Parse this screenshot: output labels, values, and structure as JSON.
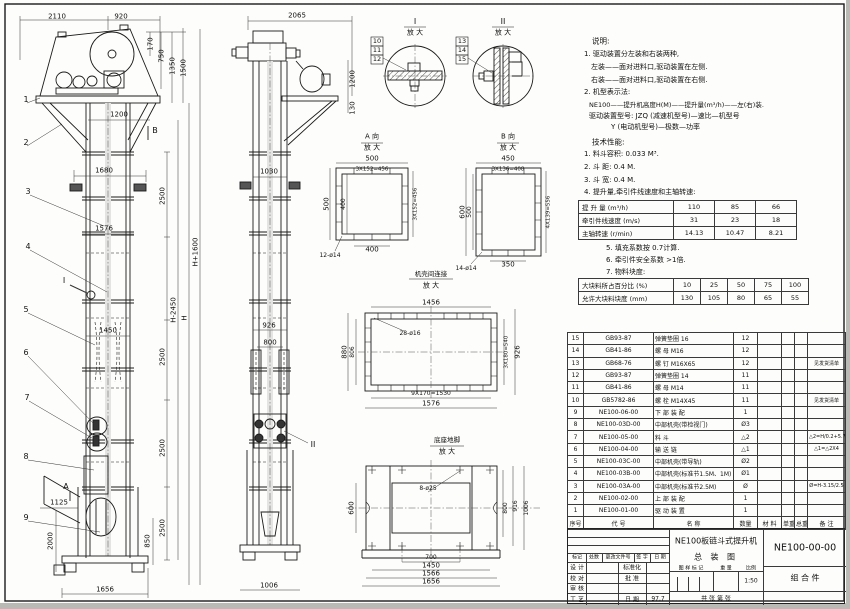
{
  "notes": {
    "heading": "说明:",
    "lines": [
      "1. 驱动装置分左装和右装两种,",
      "左装——面对进料口,驱动装置在左侧.",
      "右装——面对进料口,驱动装置在右侧.",
      "2. 机型表示法:",
      "NE100——提升机高度H(M)——提升量(m³/h)——左(右)装.",
      "驱动装置型号: JZQ (减速机型号)—速比—机型号",
      "Y (电动机型号)—极数—功率"
    ]
  },
  "tech": {
    "heading": "技术性能:",
    "lines": [
      "1. 料斗容积: 0.033 M³.",
      "2. 斗  距: 0.4 M.",
      "3. 斗  宽: 0.4 M.",
      "4. 提升量,牵引件线速度和主轴转速:"
    ],
    "extra": [
      "5. 填充系数按 0.7计算.",
      "6. 牵引件安全系数 >1倍.",
      "7. 物料块度:"
    ]
  },
  "capacity_table": {
    "rows": [
      {
        "label": "提 升 量  (m³/h)",
        "values": [
          "110",
          "85",
          "66"
        ]
      },
      {
        "label": "牵引件线速度 (m/s)",
        "values": [
          "31",
          "23",
          "18"
        ]
      },
      {
        "label": "主轴转速 (r/min)",
        "values": [
          "14.13",
          "10.47",
          "8.21"
        ]
      }
    ]
  },
  "lump_table": {
    "rows": [
      {
        "label": "大块料所占百分比 (%)",
        "values": [
          "10",
          "25",
          "50",
          "75",
          "100"
        ]
      },
      {
        "label": "允许大块料块度 (mm)",
        "values": [
          "130",
          "105",
          "80",
          "65",
          "55"
        ]
      }
    ]
  },
  "bom": {
    "headers": [
      "序号",
      "代    号",
      "名    称",
      "数量",
      "材 料",
      "单重",
      "总重",
      "备  注"
    ],
    "rows": [
      {
        "no": "15",
        "code": "GB93-87",
        "name": "弹簧垫圈  16",
        "qty": "12",
        "mat": "",
        "uw": "",
        "tw": "",
        "remark": ""
      },
      {
        "no": "14",
        "code": "GB41-86",
        "name": "螺 母  M16",
        "qty": "12",
        "mat": "",
        "uw": "",
        "tw": "",
        "remark": ""
      },
      {
        "no": "13",
        "code": "GB68-76",
        "name": "螺 钉  M16X65",
        "qty": "12",
        "mat": "",
        "uw": "",
        "tw": "",
        "remark": "见发货清单"
      },
      {
        "no": "12",
        "code": "GB93-87",
        "name": "弹簧垫圈  14",
        "qty": "11",
        "mat": "",
        "uw": "",
        "tw": "",
        "remark": ""
      },
      {
        "no": "11",
        "code": "GB41-86",
        "name": "螺 母  M14",
        "qty": "11",
        "mat": "",
        "uw": "",
        "tw": "",
        "remark": ""
      },
      {
        "no": "10",
        "code": "GB5782-86",
        "name": "螺 栓  M14X45",
        "qty": "11",
        "mat": "",
        "uw": "",
        "tw": "",
        "remark": "见发货清单"
      },
      {
        "no": "9",
        "code": "NE100-06-00",
        "name": "下 部 装 配",
        "qty": "1",
        "mat": "",
        "uw": "",
        "tw": "",
        "remark": ""
      },
      {
        "no": "8",
        "code": "NE100-03D-00",
        "name": "中部机壳(带检视门)",
        "qty": "Ø3",
        "mat": "",
        "uw": "",
        "tw": "",
        "remark": ""
      },
      {
        "no": "7",
        "code": "NE100-05-00",
        "name": "料  斗",
        "qty": "△2",
        "mat": "",
        "uw": "",
        "tw": "",
        "remark": "△2=H/0.2+5.75"
      },
      {
        "no": "6",
        "code": "NE100-04-00",
        "name": "输 送 链",
        "qty": "△1",
        "mat": "",
        "uw": "",
        "tw": "",
        "remark": "△1=△2X4"
      },
      {
        "no": "5",
        "code": "NE100-03C-00",
        "name": "中部机壳(带导轨)",
        "qty": "Ø2",
        "mat": "",
        "uw": "",
        "tw": "",
        "remark": ""
      },
      {
        "no": "4",
        "code": "NE100-03B-00",
        "name": "中部机壳(标准节1.5M、1M)",
        "qty": "Ø1",
        "mat": "",
        "uw": "",
        "tw": "",
        "remark": ""
      },
      {
        "no": "3",
        "code": "NE100-03A-00",
        "name": "中部机壳(标准节2.5M)",
        "qty": "Ø",
        "mat": "",
        "uw": "",
        "tw": "",
        "remark": "Ø=H-3.15/2.5"
      },
      {
        "no": "2",
        "code": "NE100-02-00",
        "name": "上 部 装 配",
        "qty": "1",
        "mat": "",
        "uw": "",
        "tw": "",
        "remark": ""
      },
      {
        "no": "1",
        "code": "NE100-01-00",
        "name": "驱 动 装 置",
        "qty": "1",
        "mat": "",
        "uw": "",
        "tw": "",
        "remark": ""
      }
    ]
  },
  "title_block": {
    "product": "NE100板链斗式提升机",
    "sheet_name": "总  装  图",
    "code": "NE100-00-00",
    "kind": "组  合  件",
    "scale_value": "1:50",
    "date_value": "97.7",
    "labels": {
      "mark": "标记",
      "count": "处数",
      "doc": "更改文件号",
      "sign": "签 字",
      "date": "日 期",
      "design": "设 计",
      "check": "校 对",
      "review": "审 核",
      "craft": "工 艺",
      "std": "标准化",
      "approve": "批 准",
      "date2": "日 期",
      "stamp": "图 样 标 记",
      "weight": "重 量",
      "scale": "比例",
      "sheets": "共    张  第    张"
    }
  },
  "drawing": {
    "labels": [
      {
        "t": "2110",
        "x": 57,
        "y": 17
      },
      {
        "t": "920",
        "x": 121,
        "y": 17
      },
      {
        "t": "170",
        "x": 151,
        "y": 44,
        "r": -90
      },
      {
        "t": "750",
        "x": 162,
        "y": 56,
        "r": -90
      },
      {
        "t": "1350",
        "x": 173,
        "y": 66,
        "r": -90
      },
      {
        "t": "1500",
        "x": 184,
        "y": 68,
        "r": -90
      },
      {
        "t": "1200",
        "x": 119,
        "y": 115
      },
      {
        "t": "B",
        "x": 155,
        "y": 131,
        "s": 8
      },
      {
        "t": "1680",
        "x": 104,
        "y": 171
      },
      {
        "t": "1576",
        "x": 104,
        "y": 229
      },
      {
        "t": "1450",
        "x": 108,
        "y": 331
      },
      {
        "t": "1125",
        "x": 59,
        "y": 503
      },
      {
        "t": "2000",
        "x": 51,
        "y": 541,
        "r": -90
      },
      {
        "t": "850",
        "x": 148,
        "y": 541,
        "r": -90
      },
      {
        "t": "1656",
        "x": 105,
        "y": 590
      },
      {
        "t": "2500",
        "x": 163,
        "y": 196,
        "r": -90
      },
      {
        "t": "2500",
        "x": 163,
        "y": 357,
        "r": -90
      },
      {
        "t": "2500",
        "x": 163,
        "y": 448,
        "r": -90
      },
      {
        "t": "2500",
        "x": 163,
        "y": 528,
        "r": -90
      },
      {
        "t": "H-2450",
        "x": 174,
        "y": 310,
        "r": -90
      },
      {
        "t": "H",
        "x": 185,
        "y": 318,
        "r": -90
      },
      {
        "t": "H+1600",
        "x": 196,
        "y": 252,
        "r": -90
      },
      {
        "t": "1",
        "x": 26,
        "y": 100,
        "s": 8
      },
      {
        "t": "2",
        "x": 26,
        "y": 143,
        "s": 8
      },
      {
        "t": "3",
        "x": 28,
        "y": 192,
        "s": 8
      },
      {
        "t": "4",
        "x": 28,
        "y": 247,
        "s": 8
      },
      {
        "t": "5",
        "x": 26,
        "y": 310,
        "s": 8
      },
      {
        "t": "6",
        "x": 26,
        "y": 353,
        "s": 8
      },
      {
        "t": "7",
        "x": 27,
        "y": 398,
        "s": 8
      },
      {
        "t": "8",
        "x": 26,
        "y": 457,
        "s": 8
      },
      {
        "t": "9",
        "x": 26,
        "y": 518,
        "s": 8
      },
      {
        "t": "I",
        "x": 64,
        "y": 281,
        "s": 8
      },
      {
        "t": "A",
        "x": 66,
        "y": 487,
        "s": 8
      },
      {
        "t": "2065",
        "x": 297,
        "y": 16
      },
      {
        "t": "1200",
        "x": 353,
        "y": 79,
        "r": -90
      },
      {
        "t": "130",
        "x": 353,
        "y": 108,
        "r": -90
      },
      {
        "t": "1030",
        "x": 269,
        "y": 172
      },
      {
        "t": "926",
        "x": 269,
        "y": 326
      },
      {
        "t": "800",
        "x": 270,
        "y": 343
      },
      {
        "t": "1006",
        "x": 269,
        "y": 586
      },
      {
        "t": "II",
        "x": 313,
        "y": 445,
        "s": 8
      },
      {
        "t": "10",
        "x": 377,
        "y": 41,
        "s": 6.5
      },
      {
        "t": "11",
        "x": 377,
        "y": 50,
        "s": 6.5
      },
      {
        "t": "12",
        "x": 377,
        "y": 59,
        "s": 6.5
      },
      {
        "t": "13",
        "x": 462,
        "y": 41,
        "s": 6.5
      },
      {
        "t": "14",
        "x": 462,
        "y": 50,
        "s": 6.5
      },
      {
        "t": "15",
        "x": 462,
        "y": 59,
        "s": 6.5
      },
      {
        "t": "I",
        "x": 415,
        "y": 22,
        "s": 8
      },
      {
        "t": "放 大",
        "x": 415,
        "y": 33
      },
      {
        "t": "II",
        "x": 503,
        "y": 22,
        "s": 8
      },
      {
        "t": "放 大",
        "x": 503,
        "y": 33
      },
      {
        "t": "A 向",
        "x": 372,
        "y": 137
      },
      {
        "t": "放 大",
        "x": 372,
        "y": 148
      },
      {
        "t": "B 向",
        "x": 508,
        "y": 137
      },
      {
        "t": "放 大",
        "x": 508,
        "y": 148
      },
      {
        "t": "机壳间连接",
        "x": 431,
        "y": 274,
        "s": 6.5
      },
      {
        "t": "放 大",
        "x": 431,
        "y": 286
      },
      {
        "t": "底座地脚",
        "x": 447,
        "y": 440,
        "s": 6.5
      },
      {
        "t": "放 大",
        "x": 447,
        "y": 452
      },
      {
        "t": "500",
        "x": 372,
        "y": 159
      },
      {
        "t": "3X152=456",
        "x": 372,
        "y": 170,
        "s": 5.5
      },
      {
        "t": "500",
        "x": 327,
        "y": 204,
        "r": -90
      },
      {
        "t": "400",
        "x": 344,
        "y": 204,
        "r": -90,
        "s": 6
      },
      {
        "t": "3X152=456",
        "x": 416,
        "y": 204,
        "r": -90,
        "s": 5.5
      },
      {
        "t": "400",
        "x": 372,
        "y": 250
      },
      {
        "t": "12-ø14",
        "x": 330,
        "y": 256,
        "s": 6
      },
      {
        "t": "450",
        "x": 508,
        "y": 159
      },
      {
        "t": "3X136=408",
        "x": 508,
        "y": 170,
        "s": 5.5
      },
      {
        "t": "600",
        "x": 463,
        "y": 212,
        "r": -90
      },
      {
        "t": "500",
        "x": 470,
        "y": 212,
        "r": -90,
        "s": 6
      },
      {
        "t": "4X139=556",
        "x": 549,
        "y": 212,
        "r": -90,
        "s": 5.5
      },
      {
        "t": "350",
        "x": 508,
        "y": 265
      },
      {
        "t": "14-ø14",
        "x": 466,
        "y": 269,
        "s": 6
      },
      {
        "t": "1456",
        "x": 431,
        "y": 303
      },
      {
        "t": "28-ø16",
        "x": 410,
        "y": 334,
        "s": 6
      },
      {
        "t": "880",
        "x": 345,
        "y": 352,
        "r": -90
      },
      {
        "t": "806",
        "x": 353,
        "y": 352,
        "r": -90,
        "s": 6
      },
      {
        "t": "3X180=540",
        "x": 507,
        "y": 352,
        "r": -90,
        "s": 5.5
      },
      {
        "t": "926",
        "x": 518,
        "y": 352,
        "r": -90
      },
      {
        "t": "9X170=1530",
        "x": 431,
        "y": 394,
        "s": 6
      },
      {
        "t": "1576",
        "x": 431,
        "y": 404
      },
      {
        "t": "8-ø25",
        "x": 428,
        "y": 489,
        "s": 6
      },
      {
        "t": "600",
        "x": 352,
        "y": 508,
        "r": -90
      },
      {
        "t": "800",
        "x": 506,
        "y": 508,
        "r": -90,
        "s": 6
      },
      {
        "t": "916",
        "x": 516,
        "y": 506,
        "r": -90,
        "s": 6
      },
      {
        "t": "1006",
        "x": 527,
        "y": 508,
        "r": -90,
        "s": 6
      },
      {
        "t": "700",
        "x": 431,
        "y": 558,
        "s": 6
      },
      {
        "t": "1450",
        "x": 431,
        "y": 566
      },
      {
        "t": "1566",
        "x": 431,
        "y": 574
      },
      {
        "t": "1656",
        "x": 431,
        "y": 582
      }
    ]
  }
}
